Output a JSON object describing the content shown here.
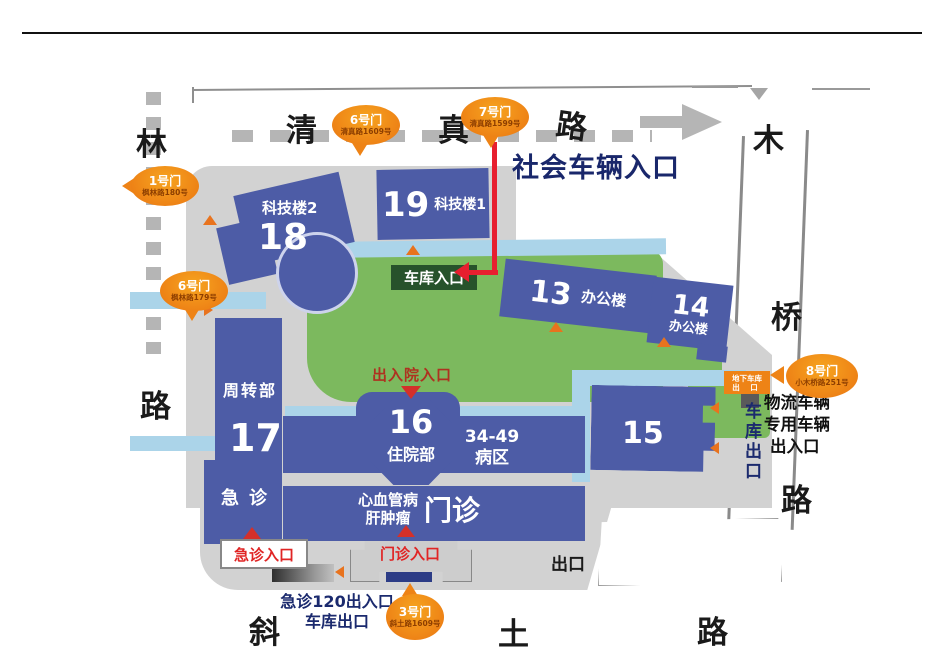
{
  "roads": {
    "fenglin": {
      "c1": "林",
      "c2": "路"
    },
    "qingzhen": {
      "c1": "清",
      "c2": "真",
      "c3": "路"
    },
    "xiaomuqiao": {
      "c1": "木",
      "c2": "桥",
      "c3": "路"
    },
    "xietu": {
      "c1": "斜",
      "c2": "土",
      "c3": "路"
    }
  },
  "gates": {
    "gate1": {
      "name": "1号门",
      "address": "枫林路180号"
    },
    "gate6_west": {
      "name": "6号门",
      "address": "枫林路179号"
    },
    "gate6_north": {
      "name": "6号门",
      "address": "清真路1609号"
    },
    "gate7": {
      "name": "7号门",
      "address": "清真路1599号"
    },
    "gate3": {
      "name": "3号门",
      "address": "斜土路1609号"
    },
    "gate8": {
      "name": "8号门",
      "address": "小木桥路251号"
    }
  },
  "buildings": {
    "b18": {
      "number": "18",
      "label": "科技楼2"
    },
    "b19": {
      "number": "19",
      "label": "科技楼1"
    },
    "b13": {
      "number": "13",
      "label": "办公楼"
    },
    "b14": {
      "number": "14",
      "label": "办公楼"
    },
    "b17": {
      "number": "17",
      "dept": "周转部",
      "er": "急诊"
    },
    "b16": {
      "number": "16",
      "label": "住院部"
    },
    "ward": {
      "line1": "34-49",
      "line2": "病区"
    },
    "b15": {
      "number": "15"
    },
    "outpatient": {
      "line1": "心血管病",
      "line2": "肝肿瘤",
      "big": "门诊"
    }
  },
  "labels": {
    "social_vehicle_entrance": "社会车辆入口",
    "garage_entrance": "车库入口",
    "admission_entrance": "出入院入口",
    "er_entrance": "急诊入口",
    "outpatient_entrance": "门诊入口",
    "exit": "出口",
    "er120_entrance": "急诊120出入口",
    "garage_exit_bottom": "车库出口",
    "garage_exit_right": "车库出口",
    "underground_garage_line1": "地下车库",
    "underground_garage_line2": "出 口",
    "logistics_line1": "物流车辆",
    "logistics_line2": "专用车辆",
    "logistics_line3": "出入口"
  },
  "colors": {
    "building_blue": "#4d5ca6",
    "green": "#7cb95e",
    "path_blue": "#abd4e9",
    "campus_gray": "#d2d2d2",
    "gate_orange": "#ee8316",
    "arrow_red": "#e71f2f",
    "navy_text": "#1b2a6e",
    "entrance_red": "#d4302a"
  }
}
